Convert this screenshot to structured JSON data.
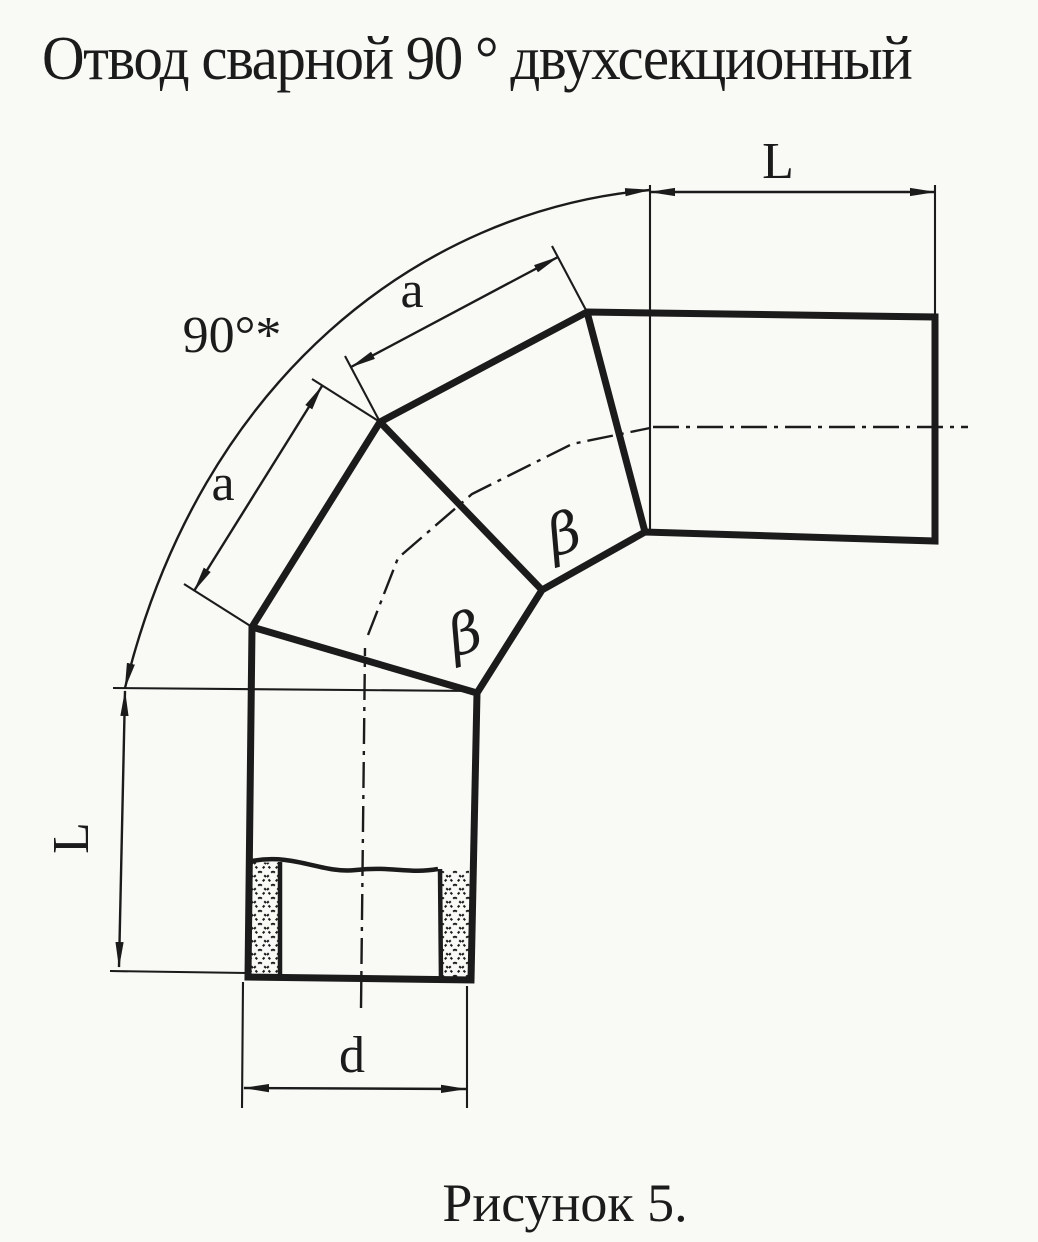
{
  "title": "Отвод сварной 90 ° двухсекционный",
  "caption": "Рисунок 5.",
  "colors": {
    "ink": "#1b1b1b",
    "paper": "#f9f9f6"
  },
  "labels": {
    "angle": "90°*",
    "length_top": "L",
    "length_left": "L",
    "segment_upper": "a",
    "segment_lower": "a",
    "diameter": "d",
    "bevel_upper": "β",
    "bevel_lower": "β"
  }
}
